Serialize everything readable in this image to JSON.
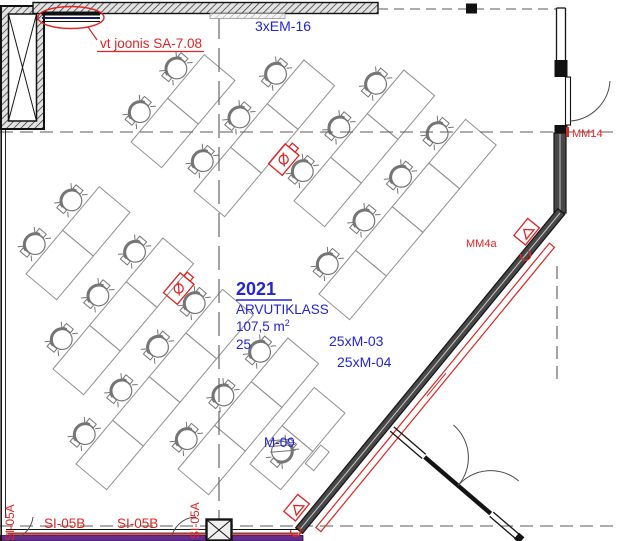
{
  "room": {
    "number": "2021",
    "name": "ARVUTIKLASS",
    "area": "107,5 m",
    "area_sup": "2",
    "capacity": "25"
  },
  "labels": {
    "cable_run": "3xEM-16",
    "drawing_note": "vt joonis SA-7.08",
    "door_mm14": "MM14",
    "device_mm4a": "MM4a",
    "monitors_1": "25xM-03",
    "monitors_2": "25xM-04",
    "teacher_unit": "M-09",
    "window_si05a_left": "SI-05A",
    "window_si05b_1": "SI-05B",
    "window_si05b_2": "SI-05B",
    "window_si05a_right": "SI-05A"
  },
  "colors": {
    "annotation_red": "#e02423",
    "label_blue": "#2323d9",
    "window_purple": "#662d91",
    "wall_dark": "#474747"
  }
}
